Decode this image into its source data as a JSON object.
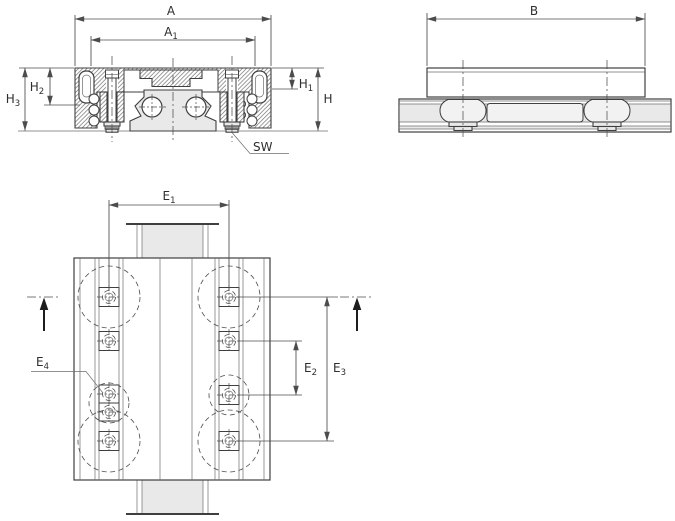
{
  "drawing": {
    "kind": "technical-dimension-drawing",
    "subject": "linear recirculating ball bearing and guideway assembly"
  },
  "labels": {
    "A": {
      "main": "A",
      "sub": ""
    },
    "A1": {
      "main": "A",
      "sub": "1"
    },
    "B": {
      "main": "B",
      "sub": ""
    },
    "H": {
      "main": "H",
      "sub": ""
    },
    "H1": {
      "main": "H",
      "sub": "1"
    },
    "H2": {
      "main": "H",
      "sub": "2"
    },
    "H3": {
      "main": "H",
      "sub": "3"
    },
    "SW": {
      "main": "SW",
      "sub": ""
    },
    "E1": {
      "main": "E",
      "sub": "1"
    },
    "E2": {
      "main": "E",
      "sub": "2"
    },
    "E3": {
      "main": "E",
      "sub": "3"
    },
    "E4": {
      "main": "E",
      "sub": "4"
    }
  },
  "colors": {
    "line": "#3f3f3f",
    "line_thin": "#6e6e6e",
    "dim": "#4c4c4c",
    "text": "#2e2e2e",
    "fill_light": "#e9e9e9",
    "hatch": "#707070",
    "background": "#ffffff"
  }
}
